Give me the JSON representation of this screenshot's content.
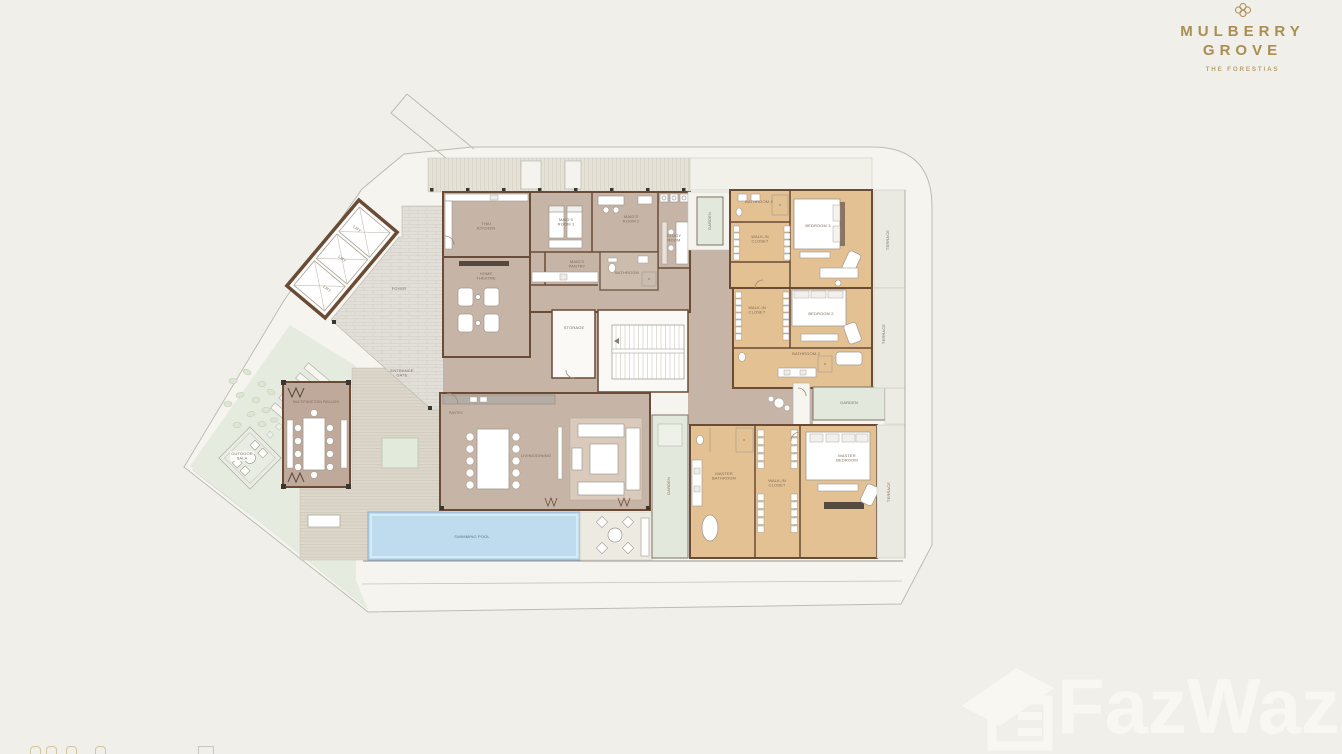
{
  "brand": {
    "line1": "MULBERRY",
    "line2": "GROVE",
    "tagline": "THE FORESTIAS"
  },
  "watermark": {
    "text": "FazWaz"
  },
  "colors": {
    "background": "#f0efe9",
    "boundary_line": "#bdbcb4",
    "wall": "#6a4b36",
    "service_floor": "#c6b4a7",
    "bedroom_floor": "#e3c193",
    "foyer_tile": "#e1dfd7",
    "deck": "#dcd7ca",
    "garden": "#e4eadf",
    "pool": "#bedcee",
    "terrace": "#ebeae2",
    "brand_gold": "#a98e52",
    "watermark_color": "#f8f7f2",
    "label_text": "#7d6c5a"
  },
  "floor_plan": {
    "labels": [
      {
        "t": "LIFT",
        "x": 357,
        "y": 229,
        "r": 40
      },
      {
        "t": "LIFT",
        "x": 342,
        "y": 259,
        "r": 40
      },
      {
        "t": "LIFT",
        "x": 327,
        "y": 289,
        "r": 40
      },
      {
        "t": "FOYER",
        "x": 399,
        "y": 289
      },
      {
        "t": "ENTRANCE\nGATE",
        "x": 402,
        "y": 373
      },
      {
        "t": "THAI\nKITCHEN",
        "x": 486,
        "y": 226
      },
      {
        "t": "HOME\nTHEATRE",
        "x": 486,
        "y": 276
      },
      {
        "t": "MAID'S\nROOM 1",
        "x": 566,
        "y": 222
      },
      {
        "t": "MAID'S\nROOM 2",
        "x": 631,
        "y": 219
      },
      {
        "t": "STUDY\nROOM",
        "x": 674,
        "y": 238
      },
      {
        "t": "MAID'S\nPANTRY",
        "x": 577,
        "y": 264
      },
      {
        "t": "BATHROOM",
        "x": 627,
        "y": 273
      },
      {
        "t": "STORAGE",
        "x": 574,
        "y": 328
      },
      {
        "t": "GARDEN",
        "x": 710,
        "y": 221,
        "r": -90
      },
      {
        "t": "BATHROOM 3",
        "x": 759,
        "y": 202
      },
      {
        "t": "WALK-IN\nCLOSET",
        "x": 760,
        "y": 239
      },
      {
        "t": "BEDROOM 3",
        "x": 818,
        "y": 226,
        "bg": 1
      },
      {
        "t": "TERRACE",
        "x": 888,
        "y": 240,
        "r": -90
      },
      {
        "t": "WALK-IN\nCLOSET",
        "x": 757,
        "y": 310
      },
      {
        "t": "BEDROOM 2",
        "x": 821,
        "y": 314,
        "bg": 1
      },
      {
        "t": "BATHROOM 2",
        "x": 806,
        "y": 354
      },
      {
        "t": "TERRACE",
        "x": 884,
        "y": 334,
        "r": -90
      },
      {
        "t": "GARDEN",
        "x": 849,
        "y": 403
      },
      {
        "t": "MASTER\nBATHROOM",
        "x": 724,
        "y": 476
      },
      {
        "t": "WALK-IN\nCLOSET",
        "x": 777,
        "y": 483
      },
      {
        "t": "MASTER\nBEDROOM",
        "x": 847,
        "y": 458,
        "bg": 1
      },
      {
        "t": "TERRACE",
        "x": 889,
        "y": 492,
        "r": -90
      },
      {
        "t": "LIVING/DINING",
        "x": 536,
        "y": 456
      },
      {
        "t": "PANTRY",
        "x": 456,
        "y": 413,
        "fs": 0.42
      },
      {
        "t": "GARDEN",
        "x": 669,
        "y": 486,
        "r": -90
      },
      {
        "t": "SWIMMING POOL",
        "x": 472,
        "y": 537,
        "c": "#56708a"
      },
      {
        "t": "MULTIFUNCTION PAVILION",
        "x": 316,
        "y": 402,
        "fs": 0.42
      },
      {
        "t": "OUTDOOR\nSALA",
        "x": 242,
        "y": 456,
        "bg": 1
      }
    ]
  }
}
